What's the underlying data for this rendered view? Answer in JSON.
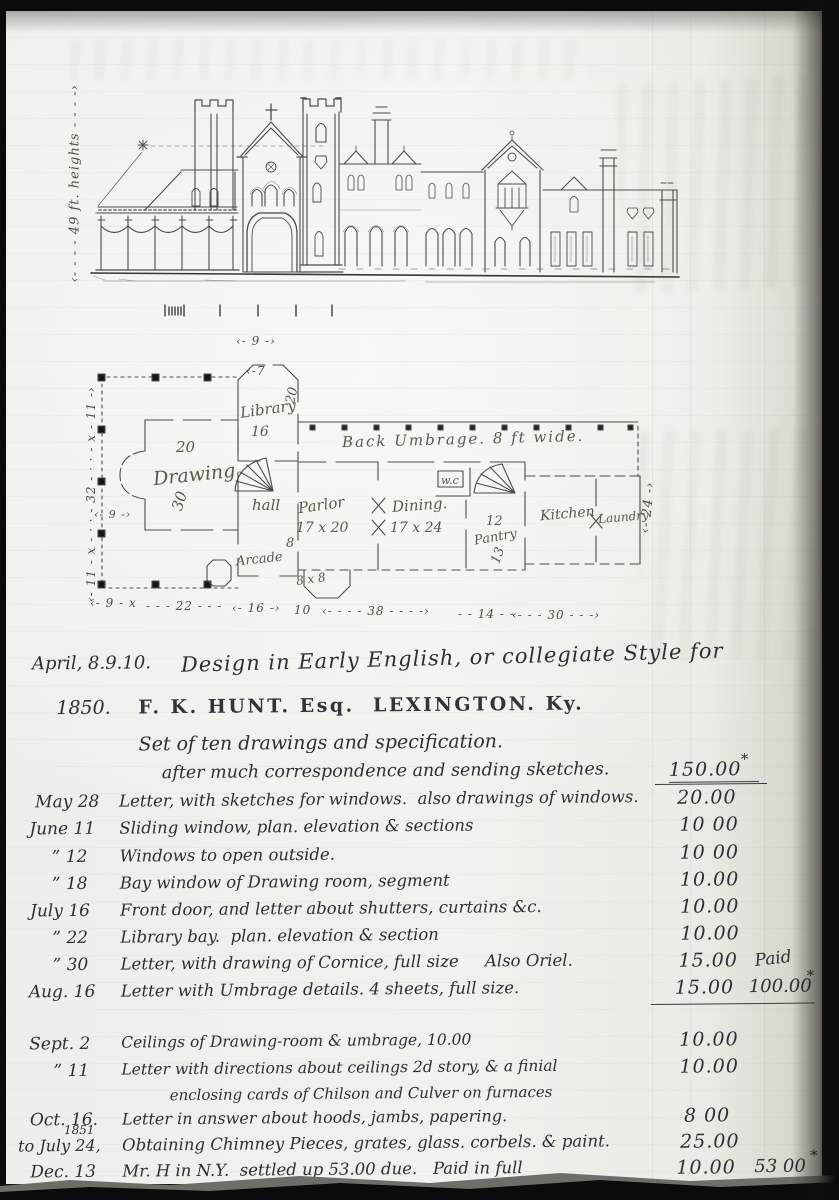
{
  "meta": {
    "kind": "architect account-book page with elevation sketch, floor plan and fee ledger"
  },
  "elevation": {
    "height_note": "‹- - - -  49 ft. heights  - - - -›"
  },
  "plan": {
    "labels": {
      "umbrage": "Back Umbrage.  8 ft wide.",
      "library": "Library",
      "library_size": "16",
      "library_depth": "20",
      "drawing": "Drawing",
      "drawing_w": "20",
      "drawing_d": "30",
      "hall": "hall",
      "arcade": "Arcade",
      "arcade_dim": "8",
      "parlor": "Parlor",
      "parlor_size": "17 x 20",
      "dining": "Dining.",
      "dining_size": "17 x 24",
      "wc": "w.c",
      "pantry_num": "12",
      "pantry": "Pantry",
      "pantry_depth": "13",
      "kitchen": "Kitchen",
      "laundry": "Laundry",
      "bay_size": "8 x 8"
    },
    "dims": {
      "top": "‹- 9 -›",
      "top_inner": "‹-7",
      "left": "‹- 11 - x - · · - 32 - · · - x - 11 -›",
      "porch": "‹- 9 -›",
      "right": "‹- 24 -›",
      "bottom": [
        "‹- 9 - x",
        "- - - 22 - - -",
        "‹- 16 -›",
        "10",
        "‹- - - -  38  - - - -›",
        "- - 14 - -",
        "‹- - -  30  - - -›"
      ]
    }
  },
  "ledger": {
    "rows": [
      {
        "date": "April, 8.9.10.",
        "desc": "Design in Early English, or collegiate Style for"
      },
      {
        "date": "1850.",
        "desc": "F. K. HUNT. Esq.  LEXINGTON. Ky."
      },
      {
        "desc": "Set of ten drawings and specification."
      },
      {
        "desc": "after much correspondence and sending sketches.",
        "amount": "150.00",
        "star": "*"
      },
      {
        "date": "May 28",
        "desc": "Letter, with sketches for windows.  also drawings of windows.",
        "amount": "20.00"
      },
      {
        "date": "June 11",
        "desc": "Sliding window, plan. elevation & sections",
        "amount": "10 00"
      },
      {
        "date": "”  12",
        "desc": "Windows to open outside.",
        "amount": "10 00"
      },
      {
        "date": "”  18",
        "desc": "Bay window of Drawing room, segment",
        "amount": "10.00"
      },
      {
        "date": "July 16",
        "desc": "Front door, and letter about shutters, curtains &c.",
        "amount": "10.00"
      },
      {
        "date": "”  22",
        "desc": "Library bay.  plan. elevation & section",
        "amount": "10.00"
      },
      {
        "date": "”  30",
        "desc": "Letter, with drawing of Cornice, full size     Also Oriel.",
        "amount": "15.00",
        "extra": "Paid"
      },
      {
        "date": "Aug. 16",
        "desc": "Letter with Umbrage details. 4 sheets, full size.",
        "amount": "15.00",
        "extra": "100.00",
        "star": "*"
      },
      {
        "date": "Sept.  2",
        "desc": "Ceilings of Drawing-room & umbrage, 10.00",
        "amount": "10.00"
      },
      {
        "date": "”  11",
        "desc": "Letter with directions about ceilings 2d story, & a finial",
        "amount": "10.00"
      },
      {
        "desc": "enclosing cards of Chilson and Culver on furnaces"
      },
      {
        "date": "Oct. 16.",
        "desc": "Letter in answer about hoods, jambs, papering.",
        "amount": "8 00"
      },
      {
        "date": "to July 24,",
        "date_super": "1851",
        "desc": "Obtaining Chimney Pieces, grates, glass. corbels. & paint.",
        "amount": "25.00"
      },
      {
        "date": "Dec. 13",
        "desc": "Mr. H in N.Y.  settled up 53.00 due.   Paid in full",
        "amount": "10.00",
        "extra": "53 00",
        "star": "*"
      }
    ]
  }
}
